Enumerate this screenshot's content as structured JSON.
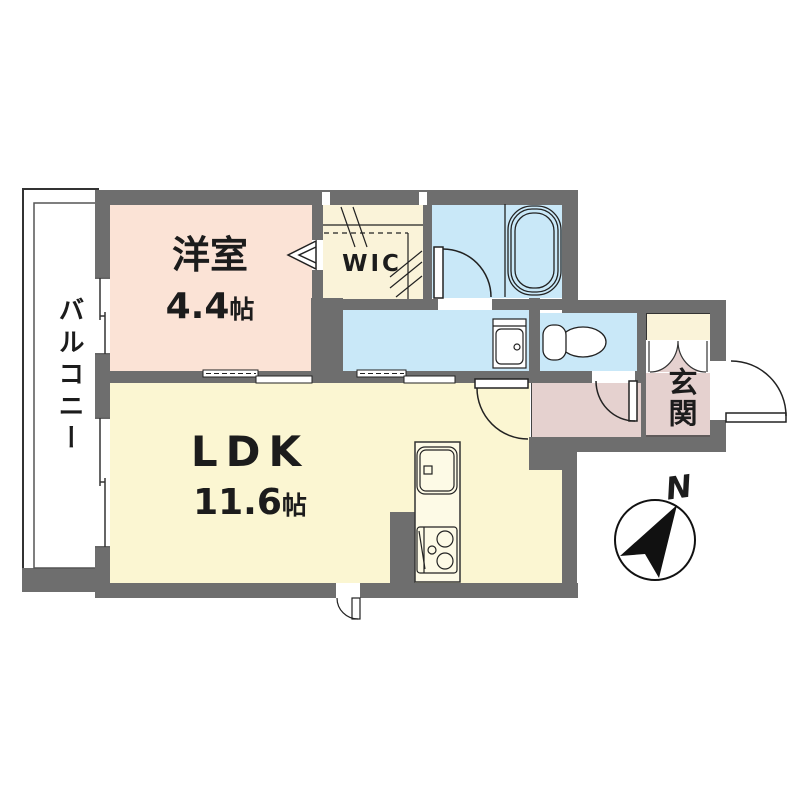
{
  "plan": {
    "balcony": {
      "label": "バルコニー"
    },
    "western_room": {
      "name": "洋室",
      "area_value": "4.4",
      "area_unit": "帖"
    },
    "wic": {
      "label": "WIC"
    },
    "ldk": {
      "name": "LDK",
      "area_value": "11.6",
      "area_unit": "帖"
    },
    "entrance": {
      "label": "玄関"
    },
    "compass": {
      "north_label": "N"
    }
  },
  "colors": {
    "wall": "#6e6e6e",
    "western_room_fill": "#fbe3d6",
    "wic_fill": "#faf3d9",
    "wet_area_fill": "#c9e8f8",
    "ldk_fill": "#fbf6d2",
    "entrance_fill": "#e5d1cf",
    "counter_fill": "#fdfae6",
    "line": "#222222"
  }
}
